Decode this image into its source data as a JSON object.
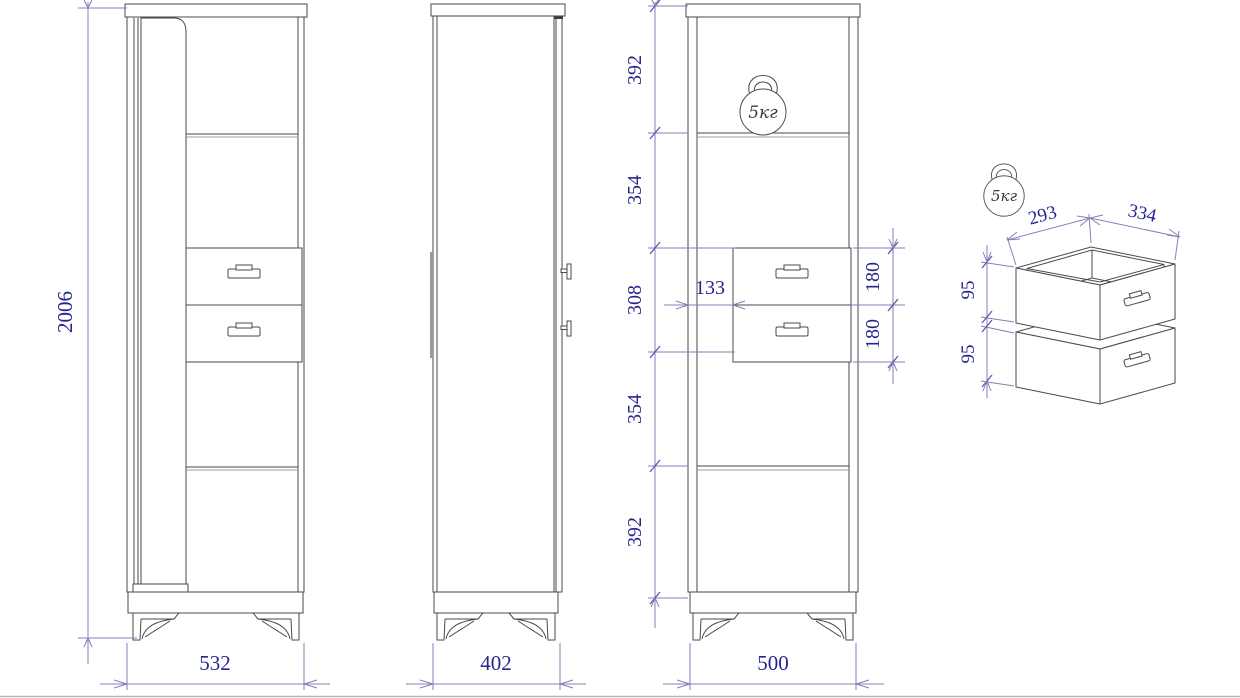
{
  "views": {
    "front": {
      "height": "2006",
      "width": "532"
    },
    "side": {
      "depth": "402"
    },
    "front_dimensioned": {
      "width": "500",
      "section_heights": [
        "392",
        "354",
        "308",
        "354",
        "392"
      ],
      "drawer_front_heights": [
        "180",
        "180"
      ],
      "drawer_side_offset": "133",
      "shelf_load": "5кг"
    },
    "drawer_detail": {
      "inner_depth": "293",
      "inner_width": "334",
      "drawer_side_heights": [
        "95",
        "95"
      ],
      "load": "5кг"
    }
  },
  "colors": {
    "dimension_text": "#26268f",
    "dimension_line": "#8082b8",
    "drawing_line": "#4a4a4a"
  }
}
